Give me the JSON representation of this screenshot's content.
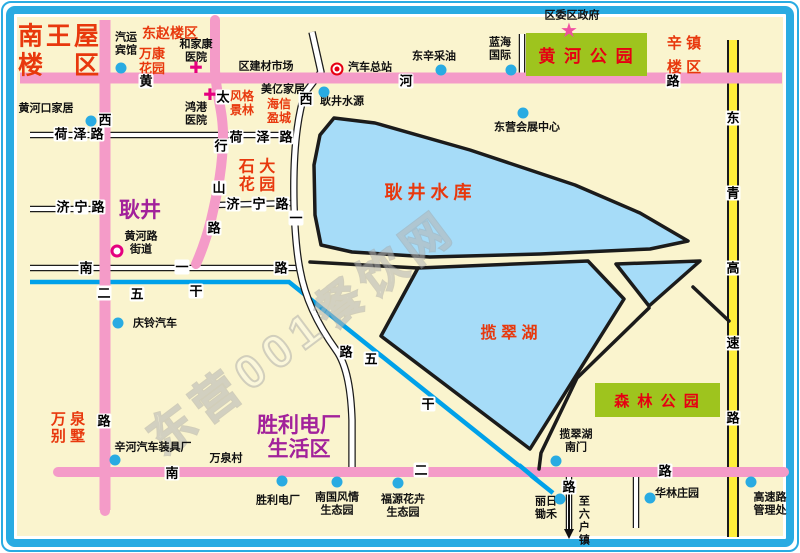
{
  "watermark": "东营001餐饮网",
  "glyphs": {
    "cross": "✚",
    "star": "★"
  },
  "colors": {
    "frame_blue": "#29ABE2",
    "land": "#FAF4CE",
    "road_pink": "#F49BC8",
    "road_yellow": "#FFEF3A",
    "lake_blue": "#A6DCF8",
    "canal_blue": "#00A1E9",
    "park_green": "#9EC41E",
    "label_red": "#E8380D",
    "label_purple": "#A2219B",
    "poi_dot_blue": "#29ABE2",
    "hospital_magenta": "#E5007F",
    "bus_red": "#E60012"
  },
  "parks": [
    {
      "name": "huanghe-park",
      "label": "黄 河 公 园",
      "x": 526,
      "y": 33,
      "w": 121,
      "h": 43,
      "size": 17
    },
    {
      "name": "forest-park",
      "label": "森 林 公 园",
      "x": 595,
      "y": 383,
      "w": 125,
      "h": 34,
      "size": 15
    }
  ],
  "areas": [
    {
      "name": "area-nanwangwu-louqu",
      "lines": [
        "南王屋",
        "楼　区"
      ],
      "x": 60,
      "y": 51,
      "size": 25,
      "ls": 3
    },
    {
      "name": "area-dongzhao-louqu",
      "lines": [
        "东赵楼区"
      ],
      "x": 170,
      "y": 33,
      "size": 14
    },
    {
      "name": "area-wankang-huayuan",
      "lines": [
        "万康",
        "花园"
      ],
      "x": 152,
      "y": 62,
      "size": 13
    },
    {
      "name": "area-fengge-jinglin",
      "lines": [
        "风格",
        "景林"
      ],
      "x": 242,
      "y": 104,
      "size": 12
    },
    {
      "name": "area-haixin-yingcheng",
      "lines": [
        "海信",
        "盈城"
      ],
      "x": 279,
      "y": 112,
      "size": 12
    },
    {
      "name": "area-shida-huayuan",
      "lines": [
        "石 大",
        "花 园"
      ],
      "x": 257,
      "y": 177,
      "size": 16
    },
    {
      "name": "area-xinzhen-louqu",
      "lines": [
        "辛 镇",
        "楼 区"
      ],
      "x": 684,
      "y": 56,
      "size": 15,
      "lh": 1.6
    },
    {
      "name": "label-gengjing-reservoir",
      "lines": [
        "耿 井 水 库"
      ],
      "x": 428,
      "y": 193,
      "size": 18
    },
    {
      "name": "label-lancui-lake",
      "lines": [
        "揽 翠 湖"
      ],
      "x": 509,
      "y": 334,
      "size": 16
    },
    {
      "name": "area-wanquan-bieshu",
      "lines": [
        "万 泉",
        "别 墅"
      ],
      "x": 68,
      "y": 428,
      "size": 15
    },
    {
      "name": "area-gengjing",
      "lines": [
        "耿井"
      ],
      "x": 140,
      "y": 211,
      "size": 21,
      "color": "#A2219B"
    },
    {
      "name": "area-shengli-dianchang-shenghuoqu",
      "lines": [
        "胜利电厂",
        "生活区"
      ],
      "x": 299,
      "y": 438,
      "size": 21,
      "color": "#A2219B"
    }
  ],
  "pois": [
    {
      "name": "poi-qiyun-binguan",
      "lines": [
        "汽运",
        "宾馆"
      ],
      "x": 126,
      "y": 44,
      "marker": {
        "type": "dot",
        "x": 121,
        "y": 68
      }
    },
    {
      "name": "poi-hejiakang-yiyuan",
      "lines": [
        "和家康",
        "医院"
      ],
      "x": 196,
      "y": 51,
      "marker": {
        "type": "cross",
        "x": 196,
        "y": 69
      }
    },
    {
      "name": "poi-qu-jiancai-shichang",
      "lines": [
        "区建材市场"
      ],
      "x": 266,
      "y": 67
    },
    {
      "name": "poi-qiche-zongzhan",
      "lines": [
        "汽车总站"
      ],
      "x": 370,
      "y": 68,
      "marker": {
        "type": "bus",
        "x": 337,
        "y": 69
      }
    },
    {
      "name": "poi-dongxin-caiyou",
      "lines": [
        "东辛采油"
      ],
      "x": 434,
      "y": 57,
      "marker": {
        "type": "dot",
        "x": 441,
        "y": 70
      }
    },
    {
      "name": "poi-lanhai-guoji",
      "lines": [
        "蓝海",
        "国际"
      ],
      "x": 500,
      "y": 49,
      "marker": {
        "type": "dot",
        "x": 511,
        "y": 70
      }
    },
    {
      "name": "poi-quwei-quzhengfu",
      "lines": [
        "区委区政府"
      ],
      "x": 572,
      "y": 16,
      "marker": {
        "type": "star",
        "x": 569,
        "y": 31
      }
    },
    {
      "name": "poi-huanghekou-jiaju",
      "lines": [
        "黄河口家居"
      ],
      "x": 46,
      "y": 109,
      "marker": {
        "type": "dot",
        "x": 91,
        "y": 121
      }
    },
    {
      "name": "poi-honggang-yiyuan",
      "lines": [
        "鸿港",
        "医院"
      ],
      "x": 196,
      "y": 114,
      "marker": {
        "type": "cross",
        "x": 210,
        "y": 96
      }
    },
    {
      "name": "poi-meiyi-jiaju",
      "lines": [
        "美亿家居"
      ],
      "x": 283,
      "y": 90
    },
    {
      "name": "poi-gengjing-shuiyuan",
      "lines": [
        "耿井水源"
      ],
      "x": 342,
      "y": 102,
      "marker": {
        "type": "dot",
        "x": 324,
        "y": 92
      }
    },
    {
      "name": "poi-dongying-huizhan-zhongxin",
      "lines": [
        "东营会展中心"
      ],
      "x": 527,
      "y": 128,
      "marker": {
        "type": "dot",
        "x": 523,
        "y": 113
      }
    },
    {
      "name": "poi-huanghelu-jiedao",
      "lines": [
        "黄河路",
        "街道"
      ],
      "x": 141,
      "y": 243,
      "marker": {
        "type": "ring",
        "x": 117,
        "y": 251
      }
    },
    {
      "name": "poi-qingling-qiche",
      "lines": [
        "庆铃汽车"
      ],
      "x": 155,
      "y": 324,
      "marker": {
        "type": "dot",
        "x": 118,
        "y": 323
      }
    },
    {
      "name": "poi-xinhe-qiche-zhuangjuchang",
      "lines": [
        "辛河汽车装具厂"
      ],
      "x": 153,
      "y": 448,
      "marker": {
        "type": "dot",
        "x": 115,
        "y": 460
      }
    },
    {
      "name": "poi-wanquancun",
      "lines": [
        "万泉村"
      ],
      "x": 226,
      "y": 459
    },
    {
      "name": "poi-shengli-dianchang",
      "lines": [
        "胜利电厂"
      ],
      "x": 278,
      "y": 501,
      "marker": {
        "type": "dot",
        "x": 282,
        "y": 481
      }
    },
    {
      "name": "poi-nanguo-fengqing",
      "lines": [
        "南国风情",
        "生态园"
      ],
      "x": 337,
      "y": 504,
      "marker": {
        "type": "dot",
        "x": 337,
        "y": 482
      }
    },
    {
      "name": "poi-fuyuan-huahui",
      "lines": [
        "福源花卉",
        "生态园"
      ],
      "x": 403,
      "y": 506,
      "marker": {
        "type": "dot",
        "x": 398,
        "y": 483
      }
    },
    {
      "name": "poi-lancuihu-nanmen",
      "lines": [
        "揽翠湖",
        "南门"
      ],
      "x": 576,
      "y": 441,
      "marker": {
        "type": "dot",
        "x": 556,
        "y": 461
      }
    },
    {
      "name": "poi-liri-chuhe",
      "lines": [
        "丽日",
        "锄禾"
      ],
      "x": 546,
      "y": 508,
      "marker": {
        "type": "dot",
        "x": 560,
        "y": 499
      }
    },
    {
      "name": "poi-hualin-zhuangyuan",
      "lines": [
        "华林庄园"
      ],
      "x": 677,
      "y": 494,
      "marker": {
        "type": "dot",
        "x": 650,
        "y": 498
      }
    },
    {
      "name": "poi-gaosulu-guanlichu",
      "lines": [
        "高速路",
        "管理处"
      ],
      "x": 770,
      "y": 504,
      "marker": {
        "type": "dot",
        "x": 751,
        "y": 482
      }
    },
    {
      "name": "poi-zhi-liuhuzhen",
      "lines": [
        "至六户镇"
      ],
      "x": 583,
      "y": 521,
      "vertical": true
    }
  ],
  "roads": [
    {
      "name": "huanghe-road",
      "chars": [
        {
          "t": "黄",
          "x": 146,
          "y": 81
        },
        {
          "t": "河",
          "x": 406,
          "y": 81
        },
        {
          "t": "路",
          "x": 673,
          "y": 81
        }
      ]
    },
    {
      "name": "xi-er-road",
      "chars": [
        {
          "t": "西",
          "x": 105,
          "y": 120
        },
        {
          "t": "二",
          "x": 104,
          "y": 293
        },
        {
          "t": "路",
          "x": 104,
          "y": 421
        }
      ]
    },
    {
      "name": "taihangshan-road",
      "chars": [
        {
          "t": "太",
          "x": 223,
          "y": 97
        },
        {
          "t": "行",
          "x": 221,
          "y": 146
        },
        {
          "t": "山",
          "x": 219,
          "y": 188
        },
        {
          "t": "路",
          "x": 214,
          "y": 228
        }
      ]
    },
    {
      "name": "xi-yi-road",
      "chars": [
        {
          "t": "西",
          "x": 306,
          "y": 99
        },
        {
          "t": "一",
          "x": 296,
          "y": 218
        },
        {
          "t": "路",
          "x": 346,
          "y": 352
        }
      ]
    },
    {
      "name": "dongqing-expressway",
      "chars": [
        {
          "t": "东",
          "x": 733,
          "y": 118
        },
        {
          "t": "青",
          "x": 733,
          "y": 193
        },
        {
          "t": "高",
          "x": 733,
          "y": 268
        },
        {
          "t": "速",
          "x": 733,
          "y": 343
        },
        {
          "t": "路",
          "x": 733,
          "y": 418
        }
      ]
    },
    {
      "name": "nan-er-road",
      "chars": [
        {
          "t": "南",
          "x": 172,
          "y": 473
        },
        {
          "t": "二",
          "x": 421,
          "y": 470
        },
        {
          "t": "路",
          "x": 665,
          "y": 471
        }
      ]
    },
    {
      "name": "nan-yi-road",
      "chars": [
        {
          "t": "南",
          "x": 86,
          "y": 268
        },
        {
          "t": "一",
          "x": 182,
          "y": 267
        },
        {
          "t": "路",
          "x": 281,
          "y": 268
        }
      ]
    },
    {
      "name": "heze-road-west",
      "chars": [
        {
          "t": "荷",
          "x": 61,
          "y": 134
        },
        {
          "t": "泽",
          "x": 80,
          "y": 134
        },
        {
          "t": "路",
          "x": 97,
          "y": 134
        }
      ]
    },
    {
      "name": "heze-road-east",
      "chars": [
        {
          "t": "荷",
          "x": 236,
          "y": 137
        },
        {
          "t": "泽",
          "x": 263,
          "y": 137
        },
        {
          "t": "路",
          "x": 286,
          "y": 137
        }
      ]
    },
    {
      "name": "jining-road-west",
      "chars": [
        {
          "t": "济",
          "x": 63,
          "y": 207
        },
        {
          "t": "宁",
          "x": 81,
          "y": 207
        },
        {
          "t": "路",
          "x": 98,
          "y": 207
        }
      ]
    },
    {
      "name": "jining-road-east",
      "chars": [
        {
          "t": "济",
          "x": 233,
          "y": 204
        },
        {
          "t": "宁",
          "x": 259,
          "y": 204
        },
        {
          "t": "路",
          "x": 282,
          "y": 204
        }
      ]
    },
    {
      "name": "wugan-canal-west",
      "chars": [
        {
          "t": "五",
          "x": 137,
          "y": 294
        },
        {
          "t": "干",
          "x": 196,
          "y": 291
        }
      ]
    },
    {
      "name": "wugan-canal-east",
      "chars": [
        {
          "t": "五",
          "x": 371,
          "y": 359
        },
        {
          "t": "干",
          "x": 428,
          "y": 404
        }
      ]
    },
    {
      "name": "liuhuzhen-road",
      "chars": [
        {
          "t": "路",
          "x": 569,
          "y": 487
        }
      ]
    }
  ]
}
